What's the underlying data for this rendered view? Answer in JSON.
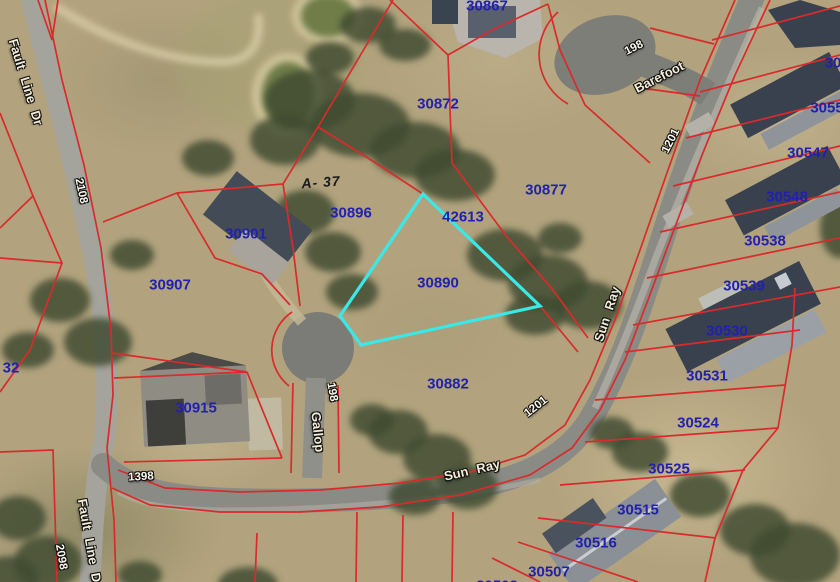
{
  "map": {
    "colors": {
      "parcel_line": "#d92b2b",
      "parcel_label": "#2121ad",
      "highlight_outline": "#3be8e8",
      "road": "#8d8d87",
      "terrain": "#b2a37e"
    },
    "highlight": {
      "points": "423,194 540,306 361,345 340,316",
      "parcel_label": "30890"
    },
    "parcel_labels": [
      {
        "text": "30867"
      },
      {
        "text": "30872"
      },
      {
        "text": "30877"
      },
      {
        "text": "30896"
      },
      {
        "text": "42613"
      },
      {
        "text": "30901"
      },
      {
        "text": "30890"
      },
      {
        "text": "30907"
      },
      {
        "text": "30882"
      },
      {
        "text": "30915"
      },
      {
        "text": "32"
      },
      {
        "text": "30"
      },
      {
        "text": "3055"
      },
      {
        "text": "30547"
      },
      {
        "text": "30548"
      },
      {
        "text": "30538"
      },
      {
        "text": "30539"
      },
      {
        "text": "30530"
      },
      {
        "text": "30531"
      },
      {
        "text": "30524"
      },
      {
        "text": "30525"
      },
      {
        "text": "30515"
      },
      {
        "text": "30516"
      },
      {
        "text": "30507"
      },
      {
        "text": "30508"
      }
    ],
    "street_names": [
      {
        "text": "Fault Line Dr"
      },
      {
        "text": "Barefoot"
      },
      {
        "text": "Sun Ray"
      },
      {
        "text": "Sun Ray"
      },
      {
        "text": "Gallop"
      },
      {
        "text": "Fault Line Dr"
      }
    ],
    "street_numbers": [
      {
        "text": "2108"
      },
      {
        "text": "198"
      },
      {
        "text": "1201"
      },
      {
        "text": "198"
      },
      {
        "text": "1201"
      },
      {
        "text": "1398"
      },
      {
        "text": "2098"
      }
    ],
    "survey_annotation": {
      "text": "A- 37"
    }
  }
}
